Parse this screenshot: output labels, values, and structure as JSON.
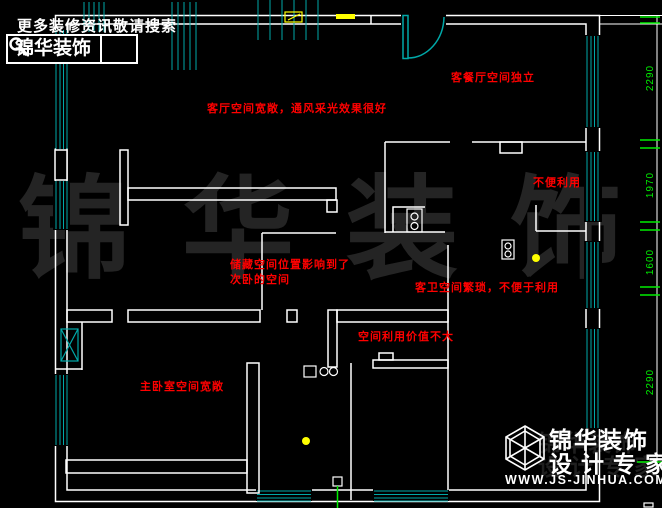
{
  "branding": {
    "tagline": "更多装修资讯敬请搜索",
    "brand": "锦华装饰",
    "icon": "search-icon"
  },
  "annotations": [
    {
      "id": "living-room",
      "text": "客厅空间宽敞，通风采光效果很好"
    },
    {
      "id": "dining-room",
      "text": "客餐厅空间独立"
    },
    {
      "id": "unusable",
      "text": "不便利用"
    },
    {
      "id": "storage-line1",
      "text": "储藏空间位置影响到了"
    },
    {
      "id": "storage-line2",
      "text": "次卧的空间"
    },
    {
      "id": "guest-bath",
      "text": "客卫空间繁琐，不便于利用"
    },
    {
      "id": "low-value",
      "text": "空间利用价值不大"
    },
    {
      "id": "master-bedroom",
      "text": "主卧室空间宽敞"
    }
  ],
  "dimensions": {
    "right": [
      "2290",
      "1970",
      "1600",
      "2290"
    ]
  },
  "watermark": "锦华装饰",
  "footer_logo": {
    "brand": "锦华装饰",
    "tagline": "设计专家",
    "website": "WWW.JS-JINHUA.COM",
    "icon": "cube-logo-icon"
  },
  "colors": {
    "background": "#000000",
    "walls": "#ffffff",
    "windows_doors": "#00a8a8",
    "annotations": "#ff0000",
    "dimensions": "#00ee00",
    "symbols": "#ffff00",
    "watermark": "#242424"
  }
}
